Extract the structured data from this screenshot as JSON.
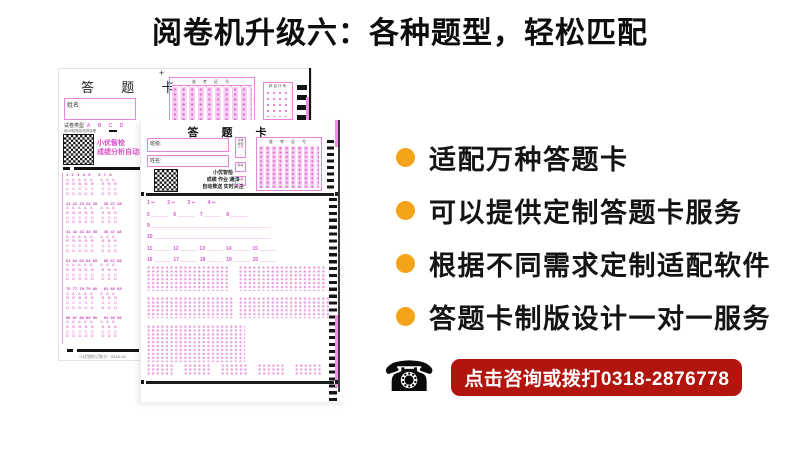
{
  "title": "阅卷机升级六：各种题型，轻松匹配",
  "colors": {
    "accent_orange": "#F5A31A",
    "banner_red": "#B2140E",
    "sheet_pink": "#e884dc"
  },
  "bullets": {
    "items": [
      "适配万种答题卡",
      "可以提供定制答题卡服务",
      "根据不同需求定制适配软件",
      "答题卡制版设计一对一服务"
    ]
  },
  "contact": {
    "phone_glyph": "☎",
    "banner_text": "点击咨询或拨打0318-2876778"
  },
  "back_sheet": {
    "title": "答 题 卡",
    "plus": "+",
    "zkz_header": "准 考 证 号",
    "subject_header": "科目代号",
    "name_label": "姓名:",
    "paper_type_label": "试卷类型  ",
    "paper_type_options": "A B C D",
    "pencil_note": "用2B铅笔将选项涂黑",
    "qr_text": "小优智检\n成绩分析自动推送",
    "footer": "小优智检订购卡：0318-28",
    "blocks": [
      {
        "rows": [
          "1   2   3   4   5       6   7   8",
          "A   A   A   A   A       A   A   A",
          "B   B   B   B   B       B   B   B",
          "C   C   C   C   C       C   C   C",
          "D   D   D   D   D       D   D   D"
        ]
      },
      {
        "rows": [
          "21  22  23  24  25      26  27  28",
          "A   A   A   A   A       A   A   A",
          "B   B   B   B   B       B   B   B",
          "C   C   C   C   C       C   C   C",
          "D   D   D   D   D       D   D   D"
        ]
      },
      {
        "rows": [
          "41  42  43  44  45      46  47  48",
          "A   A   A   A   A       A   A   A",
          "B   B   B   B   B       B   B   B",
          "C   C   C   C   C       C   C   C",
          "D   D   D   D   D       D   D   D"
        ]
      },
      {
        "rows": [
          "61  62  63  64  65      66  67  68",
          "A   A   A   A   A       A   A   A",
          "B   B   B   B   B       B   B   B",
          "C   C   C   C   C       C   C   C",
          "D   D   D   D   D       D   D   D"
        ]
      },
      {
        "rows": [
          "76  77  78  79  80      81  82  83",
          "A   A   A   A   A       A   A   A",
          "B   B   B   B   B       B   B   B",
          "C   C   C   C   C       C   C   C",
          "D   D   D   D   D       D   D   D"
        ]
      },
      {
        "rows": [
          "86  87  88  89  90      91  92  93",
          "A   A   A   A   A       A   A   A",
          "B   B   B   B   B       B   B   B",
          "C   C   C   C   C       C   C   C",
          "D   D   D   D   D       D   D   D"
        ]
      }
    ]
  },
  "front_sheet": {
    "title": "答 题 卡",
    "class_label": "班级:",
    "name_label": "姓名:",
    "qr_lines": [
      "小优智检",
      "成绩 作业 通知",
      "自动推送 实时关注"
    ],
    "mini_boxes": [
      "试卷 类型",
      "缺考",
      "条码"
    ],
    "mini_ab": "A B",
    "zkz_header": "准 考 证 号",
    "q_rows": [
      "1 ▪▪         2 ▪▪         3 ▪▪         4 ▪▪",
      "5 ______    6 ______    7 ______    8 ______",
      "9 ___________________________________________",
      "10 __________________________________________",
      "11 ______  12 ______  13 ______  14 ______  15 ______",
      "16 ______  17 ______  18 ______  19 ______  20 ______"
    ]
  }
}
